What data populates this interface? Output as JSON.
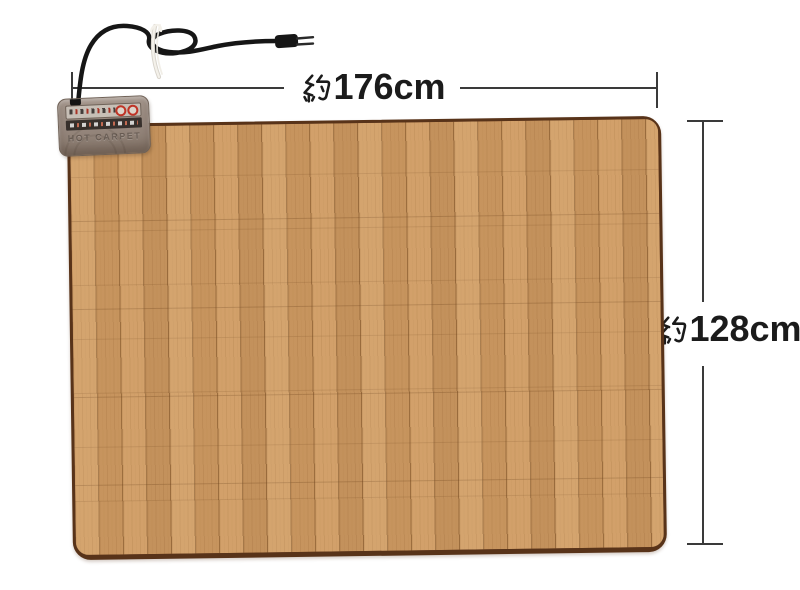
{
  "product": {
    "type": "wood-grain electric hot carpet",
    "controller_label": "HOT CARPET",
    "colors": {
      "wood_base": "#cf9c64",
      "wood_seam": "#70461e",
      "edge_binding": "#583319",
      "controller_body": "#99897f",
      "cord": "#161616",
      "cable_tie": "#f2efe9"
    }
  },
  "annotations": {
    "width": {
      "label": "約176cm",
      "prefix": "約",
      "value": "176cm"
    },
    "height": {
      "label": "約128cm",
      "prefix": "約",
      "value": "128cm"
    },
    "line_color": "#3a3a3a",
    "text_color": "#1b1b1b"
  },
  "background_color": "#ffffff"
}
